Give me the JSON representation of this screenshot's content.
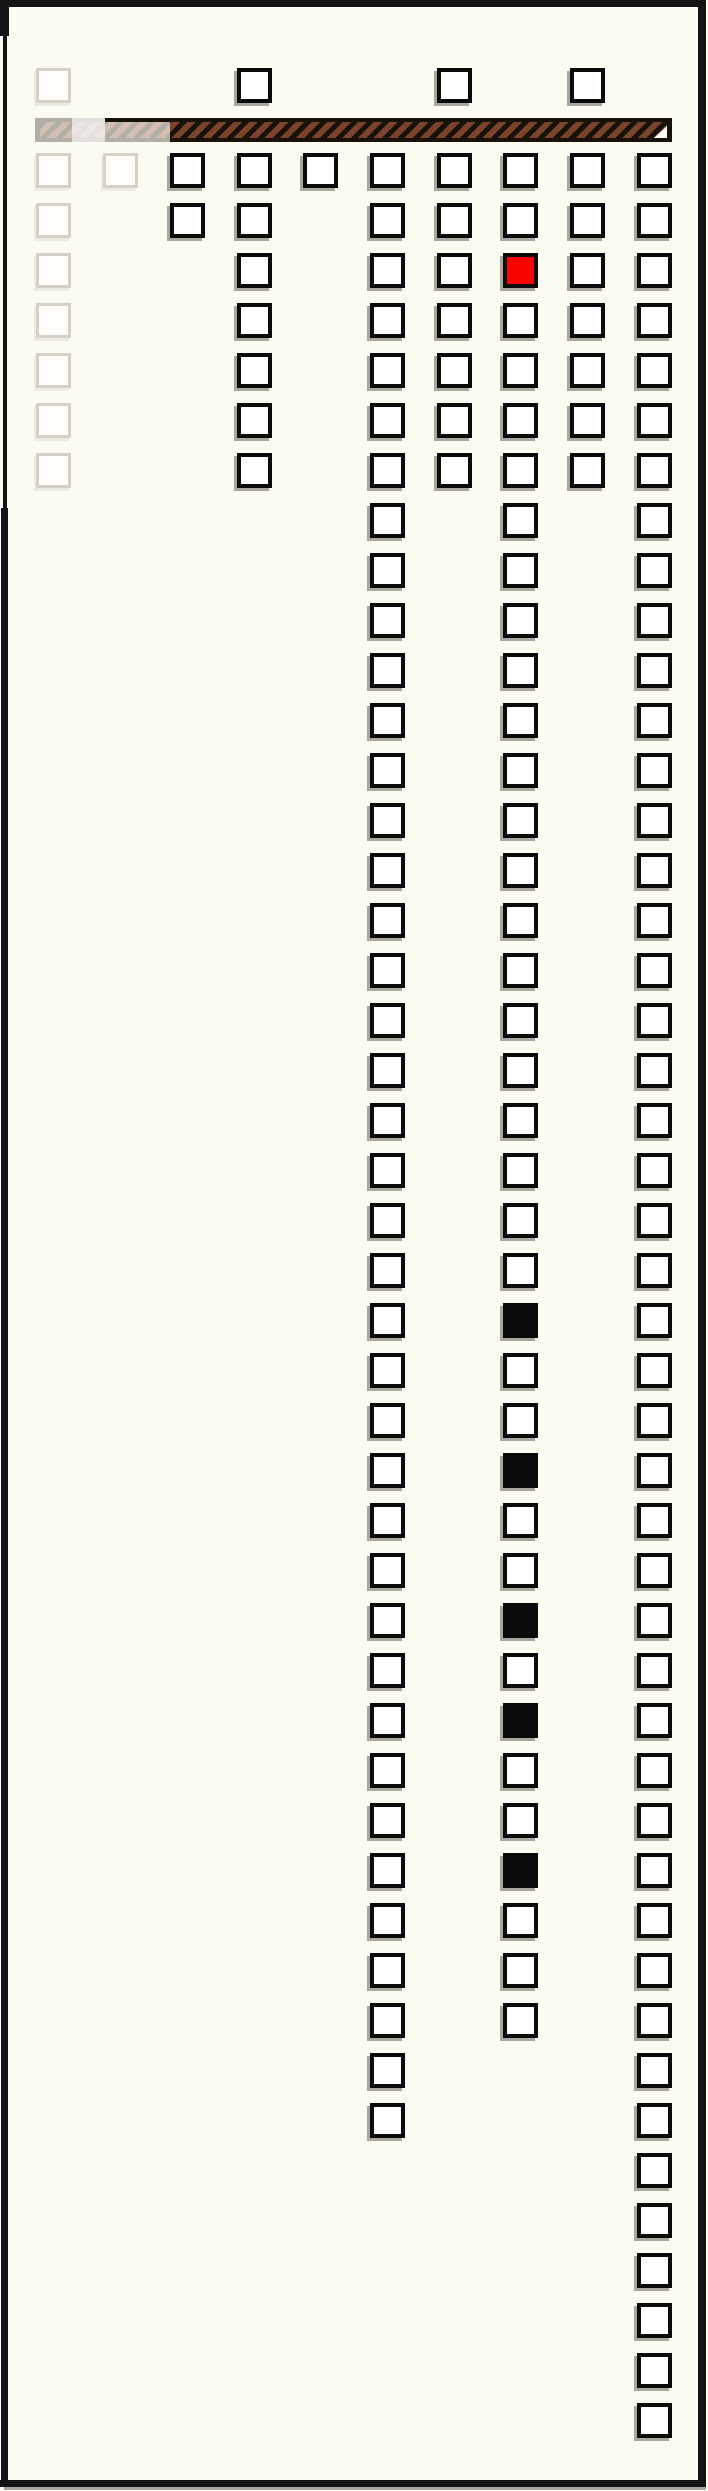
{
  "page": {
    "description": "framed cream page with columns of checkbox squares and a striped fuse bar",
    "width": 708,
    "height": 2491
  },
  "colors": {
    "background": "#FCFBF1",
    "frame": "#141414",
    "square_border": "#0B0B0B",
    "square_fill": "#FFFFFF",
    "faint_border": "#D4D1C7",
    "red_fill": "#F90400",
    "black_fill": "#0B0B0B",
    "shadow": "#A9A69D",
    "bar_base": "#17120C",
    "bar_stripe": "#7B4329",
    "bar_tip": "#FFFFFF"
  },
  "fuse_bar": {
    "x": 35,
    "y": 118,
    "width": 637,
    "height": 24,
    "stripe_direction": "diagonal-forward-slash",
    "tip_icon": "white-triangle",
    "faded_left_portion_end_x": 170
  },
  "grid": {
    "square_size": 35,
    "row_pitch": 50,
    "first_row_y": 153,
    "float_row_y": 68,
    "column_x": [
      36,
      103,
      170,
      237,
      303,
      370,
      437,
      503,
      570,
      637
    ],
    "columns": [
      {
        "id": 0,
        "style": "faint",
        "float_square": true,
        "rows_from": 0,
        "rows_to": 6
      },
      {
        "id": 1,
        "style": "faint",
        "float_square": false,
        "rows_from": 0,
        "rows_to": 0
      },
      {
        "id": 2,
        "style": "normal",
        "float_square": false,
        "rows_from": 0,
        "rows_to": 1
      },
      {
        "id": 3,
        "style": "normal",
        "float_square": true,
        "rows_from": 0,
        "rows_to": 6
      },
      {
        "id": 4,
        "style": "normal",
        "float_square": false,
        "rows_from": 0,
        "rows_to": 0
      },
      {
        "id": 5,
        "style": "normal",
        "float_square": false,
        "rows_from": 0,
        "rows_to": 39
      },
      {
        "id": 6,
        "style": "normal",
        "float_square": true,
        "rows_from": 0,
        "rows_to": 6
      },
      {
        "id": 7,
        "style": "normal",
        "float_square": false,
        "rows_from": 0,
        "rows_to": 37
      },
      {
        "id": 8,
        "style": "normal",
        "float_square": true,
        "rows_from": 0,
        "rows_to": 6
      },
      {
        "id": 9,
        "style": "normal",
        "float_square": false,
        "rows_from": 0,
        "rows_to": 45
      }
    ],
    "special_cells": [
      {
        "col": 7,
        "row": 2,
        "fill": "red"
      },
      {
        "col": 7,
        "row": 23,
        "fill": "black"
      },
      {
        "col": 7,
        "row": 26,
        "fill": "black"
      },
      {
        "col": 7,
        "row": 29,
        "fill": "black"
      },
      {
        "col": 7,
        "row": 31,
        "fill": "black"
      },
      {
        "col": 7,
        "row": 34,
        "fill": "black"
      }
    ]
  }
}
